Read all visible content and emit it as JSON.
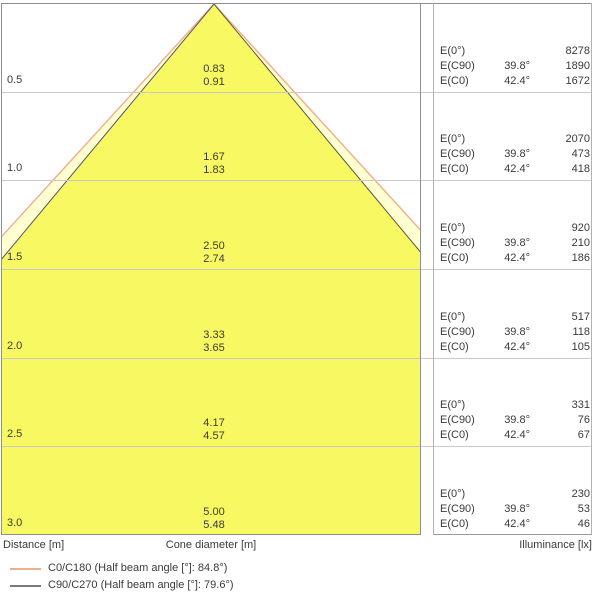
{
  "figure": {
    "type": "illuminance-cone-diagram",
    "axis_labels": {
      "distance": "Distance [m]",
      "cone": "Cone diameter [m]",
      "illuminance": "Illuminance [lx]"
    },
    "e_labels": {
      "e0": "E(0°)",
      "ec90": "E(C90)",
      "ec0": "E(C0)"
    },
    "angles": {
      "c90": "39.8°",
      "c0": "42.4°"
    },
    "rows": [
      {
        "distance": "0.5",
        "cone_c90": "0.83",
        "cone_c0": "0.91",
        "e0": "8278",
        "e_c90": "1890",
        "e_c0": "1672"
      },
      {
        "distance": "1.0",
        "cone_c90": "1.67",
        "cone_c0": "1.83",
        "e0": "2070",
        "e_c90": "473",
        "e_c0": "418"
      },
      {
        "distance": "1.5",
        "cone_c90": "2.50",
        "cone_c0": "2.74",
        "e0": "920",
        "e_c90": "210",
        "e_c0": "186"
      },
      {
        "distance": "2.0",
        "cone_c90": "3.33",
        "cone_c0": "3.65",
        "e0": "517",
        "e_c90": "118",
        "e_c0": "105"
      },
      {
        "distance": "2.5",
        "cone_c90": "4.17",
        "cone_c0": "4.57",
        "e0": "331",
        "e_c90": "76",
        "e_c0": "67"
      },
      {
        "distance": "3.0",
        "cone_c90": "5.00",
        "cone_c0": "5.48",
        "e0": "230",
        "e_c90": "53",
        "e_c0": "46"
      }
    ],
    "legend": [
      {
        "label": "C0/C180 (Half beam angle [°]: 84.8°)",
        "color": "#efae8d"
      },
      {
        "label": "C90/C270 (Half beam angle [°]: 79.6°)",
        "color": "#7a7a7a"
      }
    ],
    "colors": {
      "cone_outer_fill": "#ffffd2",
      "cone_outer_stroke": "#efae8d",
      "cone_inner_fill": "#f8f862",
      "cone_inner_stroke": "#565656"
    }
  },
  "chart_data": {
    "type": "table",
    "title": "Luminaire light cone diagram — cone diameter and illuminance vs distance",
    "categories_label": "Distance [m]",
    "categories": [
      0.5,
      1.0,
      1.5,
      2.0,
      2.5,
      3.0
    ],
    "series": [
      {
        "name": "Cone diameter C90/C270 [m]",
        "values": [
          0.83,
          1.67,
          2.5,
          3.33,
          4.17,
          5.0
        ]
      },
      {
        "name": "Cone diameter C0/C180 [m]",
        "values": [
          0.91,
          1.83,
          2.74,
          3.65,
          4.57,
          5.48
        ]
      },
      {
        "name": "E(0°) [lx]",
        "values": [
          8278,
          2070,
          920,
          517,
          331,
          230
        ]
      },
      {
        "name": "E(C90) [lx]",
        "values": [
          1890,
          473,
          210,
          118,
          76,
          53
        ]
      },
      {
        "name": "E(C0) [lx]",
        "values": [
          1672,
          418,
          186,
          105,
          67,
          46
        ]
      }
    ],
    "annotations": {
      "half_beam_angle_c0_c180": "84.8°",
      "half_beam_angle_c90_c270": "79.6°",
      "e_c90_angle_column": "39.8°",
      "e_c0_angle_column": "42.4°"
    },
    "legend_position": "bottom-left",
    "grid": true
  }
}
